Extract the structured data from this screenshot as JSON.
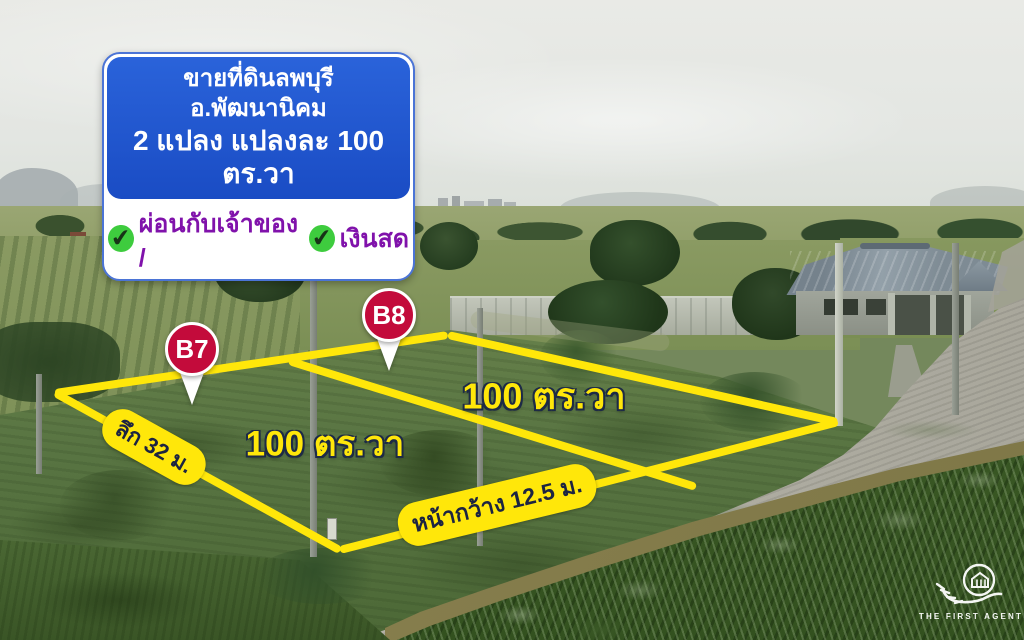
{
  "banner": {
    "line1": "ขายที่ดินลพบุรี  อ.พัฒนานิคม",
    "line2": "2 แปลง แปลงละ 100 ตร.วา",
    "check1": "✔",
    "payment_installment": "ผ่อนกับเจ้าของ /",
    "check2": "✔",
    "payment_cash": "เงินสด"
  },
  "pins": [
    {
      "label": "B7"
    },
    {
      "label": "B8"
    }
  ],
  "plots": {
    "b7_area": "100 ตร.วา",
    "b8_area": "100 ตร.วา"
  },
  "measurements": {
    "depth": "ลึก 32 ม.",
    "frontage": "หน้ากว้าง 12.5 ม."
  },
  "logo": {
    "text": "THE FIRST AGENT"
  },
  "colors": {
    "line_yellow": "#ffe70a",
    "banner_blue": "#1d55cd",
    "payment_purple": "#8012ab",
    "check_green": "#3ecc3e",
    "pin_red": "#c30b3b"
  }
}
